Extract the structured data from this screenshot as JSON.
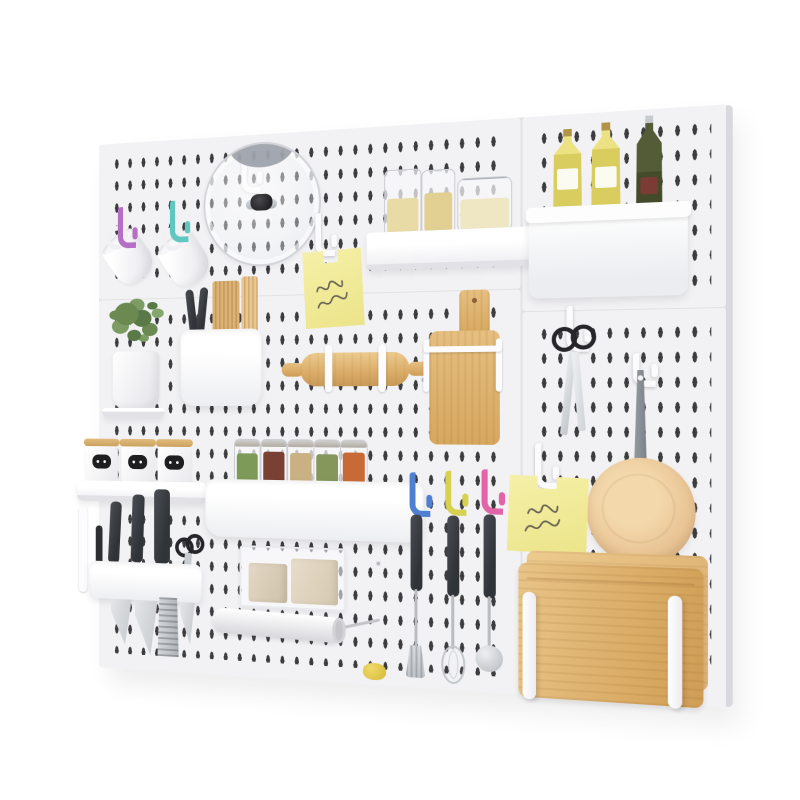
{
  "scene": {
    "type": "product-photo",
    "subject": "White kitchen pegboard wall organizer with accessories",
    "background_color": "#ffffff"
  },
  "board": {
    "color": "#f2f2f4",
    "slot_color": "#2d2d30",
    "seam_color": "#e2e2e5",
    "panel_count": 4
  },
  "palette": {
    "wood": "#d8a962",
    "wood_light": "#e9c488",
    "pan_beige": "#e9c494",
    "sticky_note": "#f1ec9f",
    "hook_purple": "#b56fc4",
    "hook_teal": "#5fc6c0",
    "hook_blue": "#4f7fd0",
    "hook_yellow": "#d6d14f",
    "hook_pink": "#e263a8",
    "olive_oil": "#d9cd5f",
    "green_bottle": "#4a5330",
    "plant_green": "#6b8a52",
    "steel": "#c7cacd",
    "dark_handle": "#3e4146"
  },
  "items": [
    {
      "id": "hook-purple",
      "label": "purple peg hook",
      "color": "#b56fc4"
    },
    {
      "id": "hook-teal",
      "label": "teal peg hook",
      "color": "#5fc6c0"
    },
    {
      "id": "mug-left",
      "label": "white mug hanging from hook"
    },
    {
      "id": "mug-right",
      "label": "white mug hanging from hook"
    },
    {
      "id": "pot-lid",
      "label": "glass pot lid with black knob hung on white hook"
    },
    {
      "id": "sticky-note-top",
      "label": "yellow sticky note with illegible mirrored handwriting",
      "color": "#f1ec9f"
    },
    {
      "id": "pasta-shelf",
      "label": "white shelf with three glass pasta jars"
    },
    {
      "id": "oil-bin",
      "label": "white storage bin with two olive-oil bottles and one dark green bottle"
    },
    {
      "id": "plant",
      "label": "green potted plant in white pot"
    },
    {
      "id": "utensil-cup",
      "label": "white holder with chopsticks and tongs"
    },
    {
      "id": "rolling-pin",
      "label": "wooden rolling pin on white wire holders"
    },
    {
      "id": "small-cutting-board",
      "label": "small wooden chopping board in white wire holder"
    },
    {
      "id": "kitchen-scissors",
      "label": "black-handled kitchen scissors hanging"
    },
    {
      "id": "frying-pan",
      "label": "beige frying pan hanging by grey handle"
    },
    {
      "id": "sticky-note-right",
      "label": "yellow sticky note with illegible mirrored handwriting",
      "color": "#f1ec9f"
    },
    {
      "id": "canister-shelf",
      "label": "three white canisters with wooden lids and black labels on white shelf"
    },
    {
      "id": "knife-rack",
      "label": "white knife rack with knives, shears and grater"
    },
    {
      "id": "spice-rack",
      "label": "five glass spice jars on white tray",
      "contents_colors": [
        "#7d9a58",
        "#7a4034",
        "#c9b184",
        "#85975a",
        "#c76a36"
      ]
    },
    {
      "id": "utensil-hooks",
      "label": "blue, yellow and pink hooks with hanging spatula, whisk and ladle",
      "hook_colors": [
        "#4f7fd0",
        "#d6d14f",
        "#e263a8"
      ]
    },
    {
      "id": "clear-bin",
      "label": "clear bin holding two paper bags"
    },
    {
      "id": "wrap-roll",
      "label": "white roll on wire holder"
    },
    {
      "id": "stacked-boards",
      "label": "stacked wooden cutting boards behind white pegs"
    },
    {
      "id": "yellow-tool",
      "label": "small yellow utensil"
    }
  ]
}
